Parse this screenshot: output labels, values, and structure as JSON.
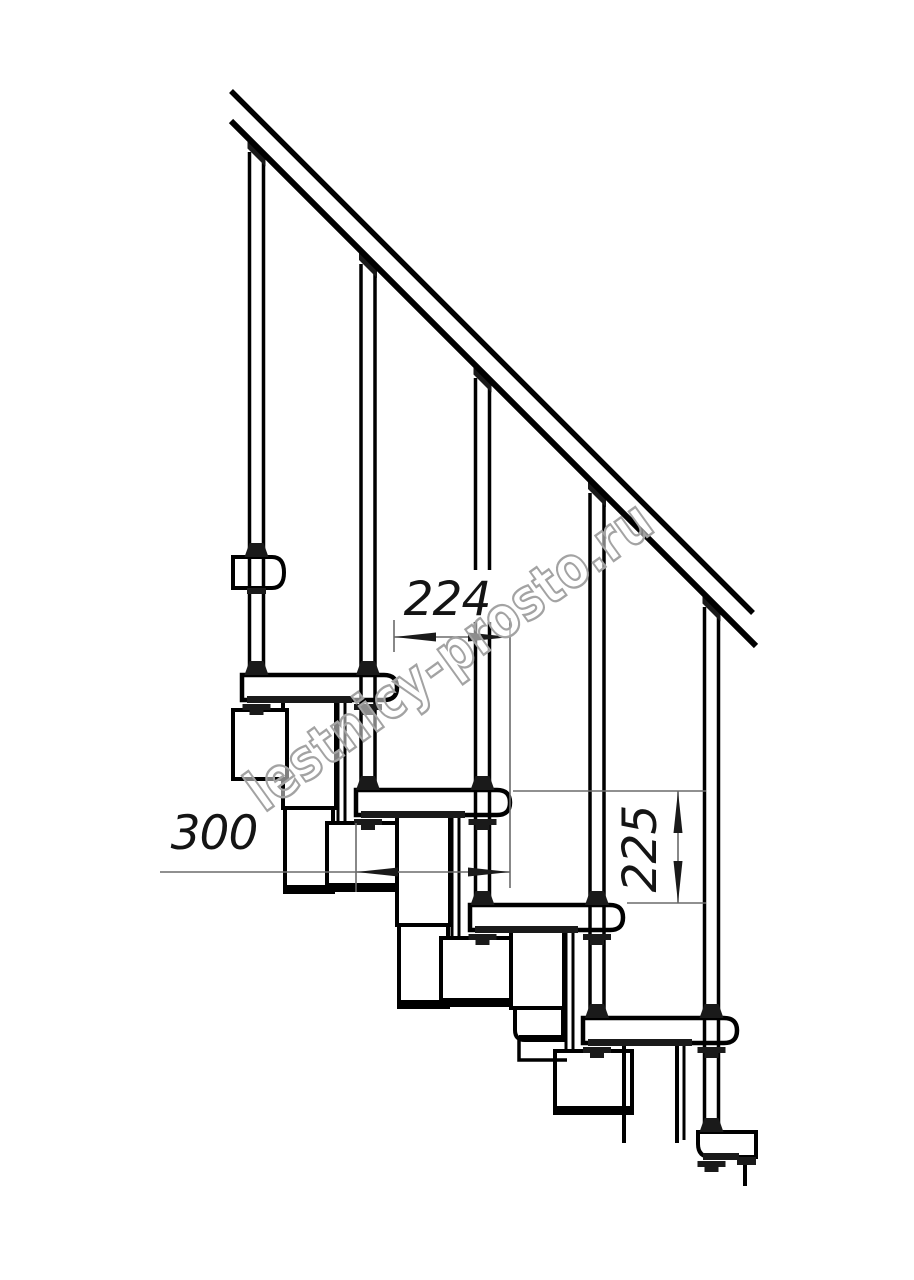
{
  "dimensions": {
    "horizontal_upper": "224",
    "horizontal_lower": "300",
    "vertical": "225"
  },
  "watermark": {
    "text": "lestnicy-prosto.ru"
  },
  "colors": {
    "background": "#ffffff",
    "drawing_line": "#000000",
    "dimension_line": "#6b6b6b",
    "dimension_text": "#141414",
    "watermark_outline": "#a3a3a3",
    "watermark_fill": "rgba(255,255,255,0.5)"
  }
}
